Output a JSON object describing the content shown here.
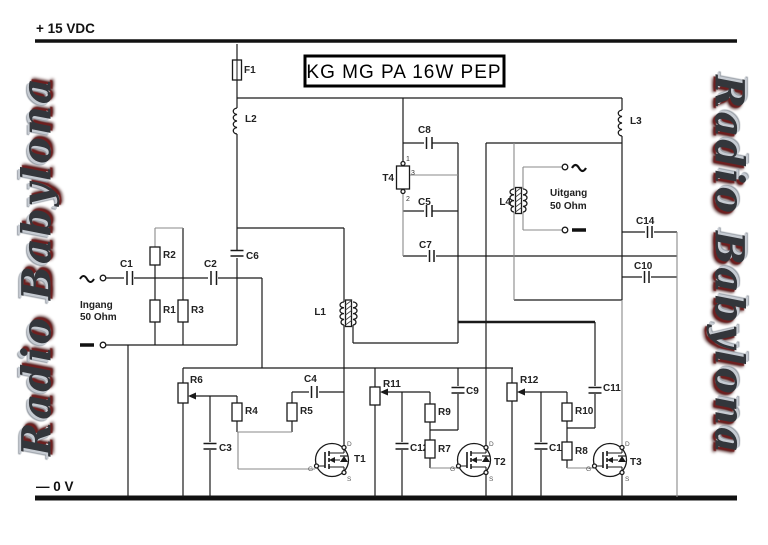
{
  "title": "KG MG PA 16W  PEP",
  "rails": {
    "top": "+ 15 VDC",
    "bottom": "— 0 V"
  },
  "watermark": "Radio Babylona",
  "io": {
    "input_line1": "Ingang",
    "input_line2": "50 Ohm",
    "output_line1": "Uitgang",
    "output_line2": "50 Ohm"
  },
  "labels": {
    "f1": "F1",
    "l1": "L1",
    "l2": "L2",
    "l3": "L3",
    "l4": "L4",
    "t1": "T1",
    "t2": "T2",
    "t3": "T3",
    "t4": "T4",
    "c1": "C1",
    "c2": "C2",
    "c3": "C3",
    "c4": "C4",
    "c5": "C5",
    "c6": "C6",
    "c7": "C7",
    "c8": "C8",
    "c9": "C9",
    "c10": "C10",
    "c11": "C11",
    "c12": "C12",
    "c13": "C13",
    "c14": "C14",
    "r1": "R1",
    "r2": "R2",
    "r3": "R3",
    "r4": "R4",
    "r5": "R5",
    "r6": "R6",
    "r7": "R7",
    "r8": "R8",
    "r9": "R9",
    "r10": "R10",
    "r11": "R11",
    "r12": "R12"
  },
  "pins": {
    "one": "1",
    "two": "2",
    "three": "3",
    "drain": "D",
    "gate": "G",
    "source": "S"
  }
}
